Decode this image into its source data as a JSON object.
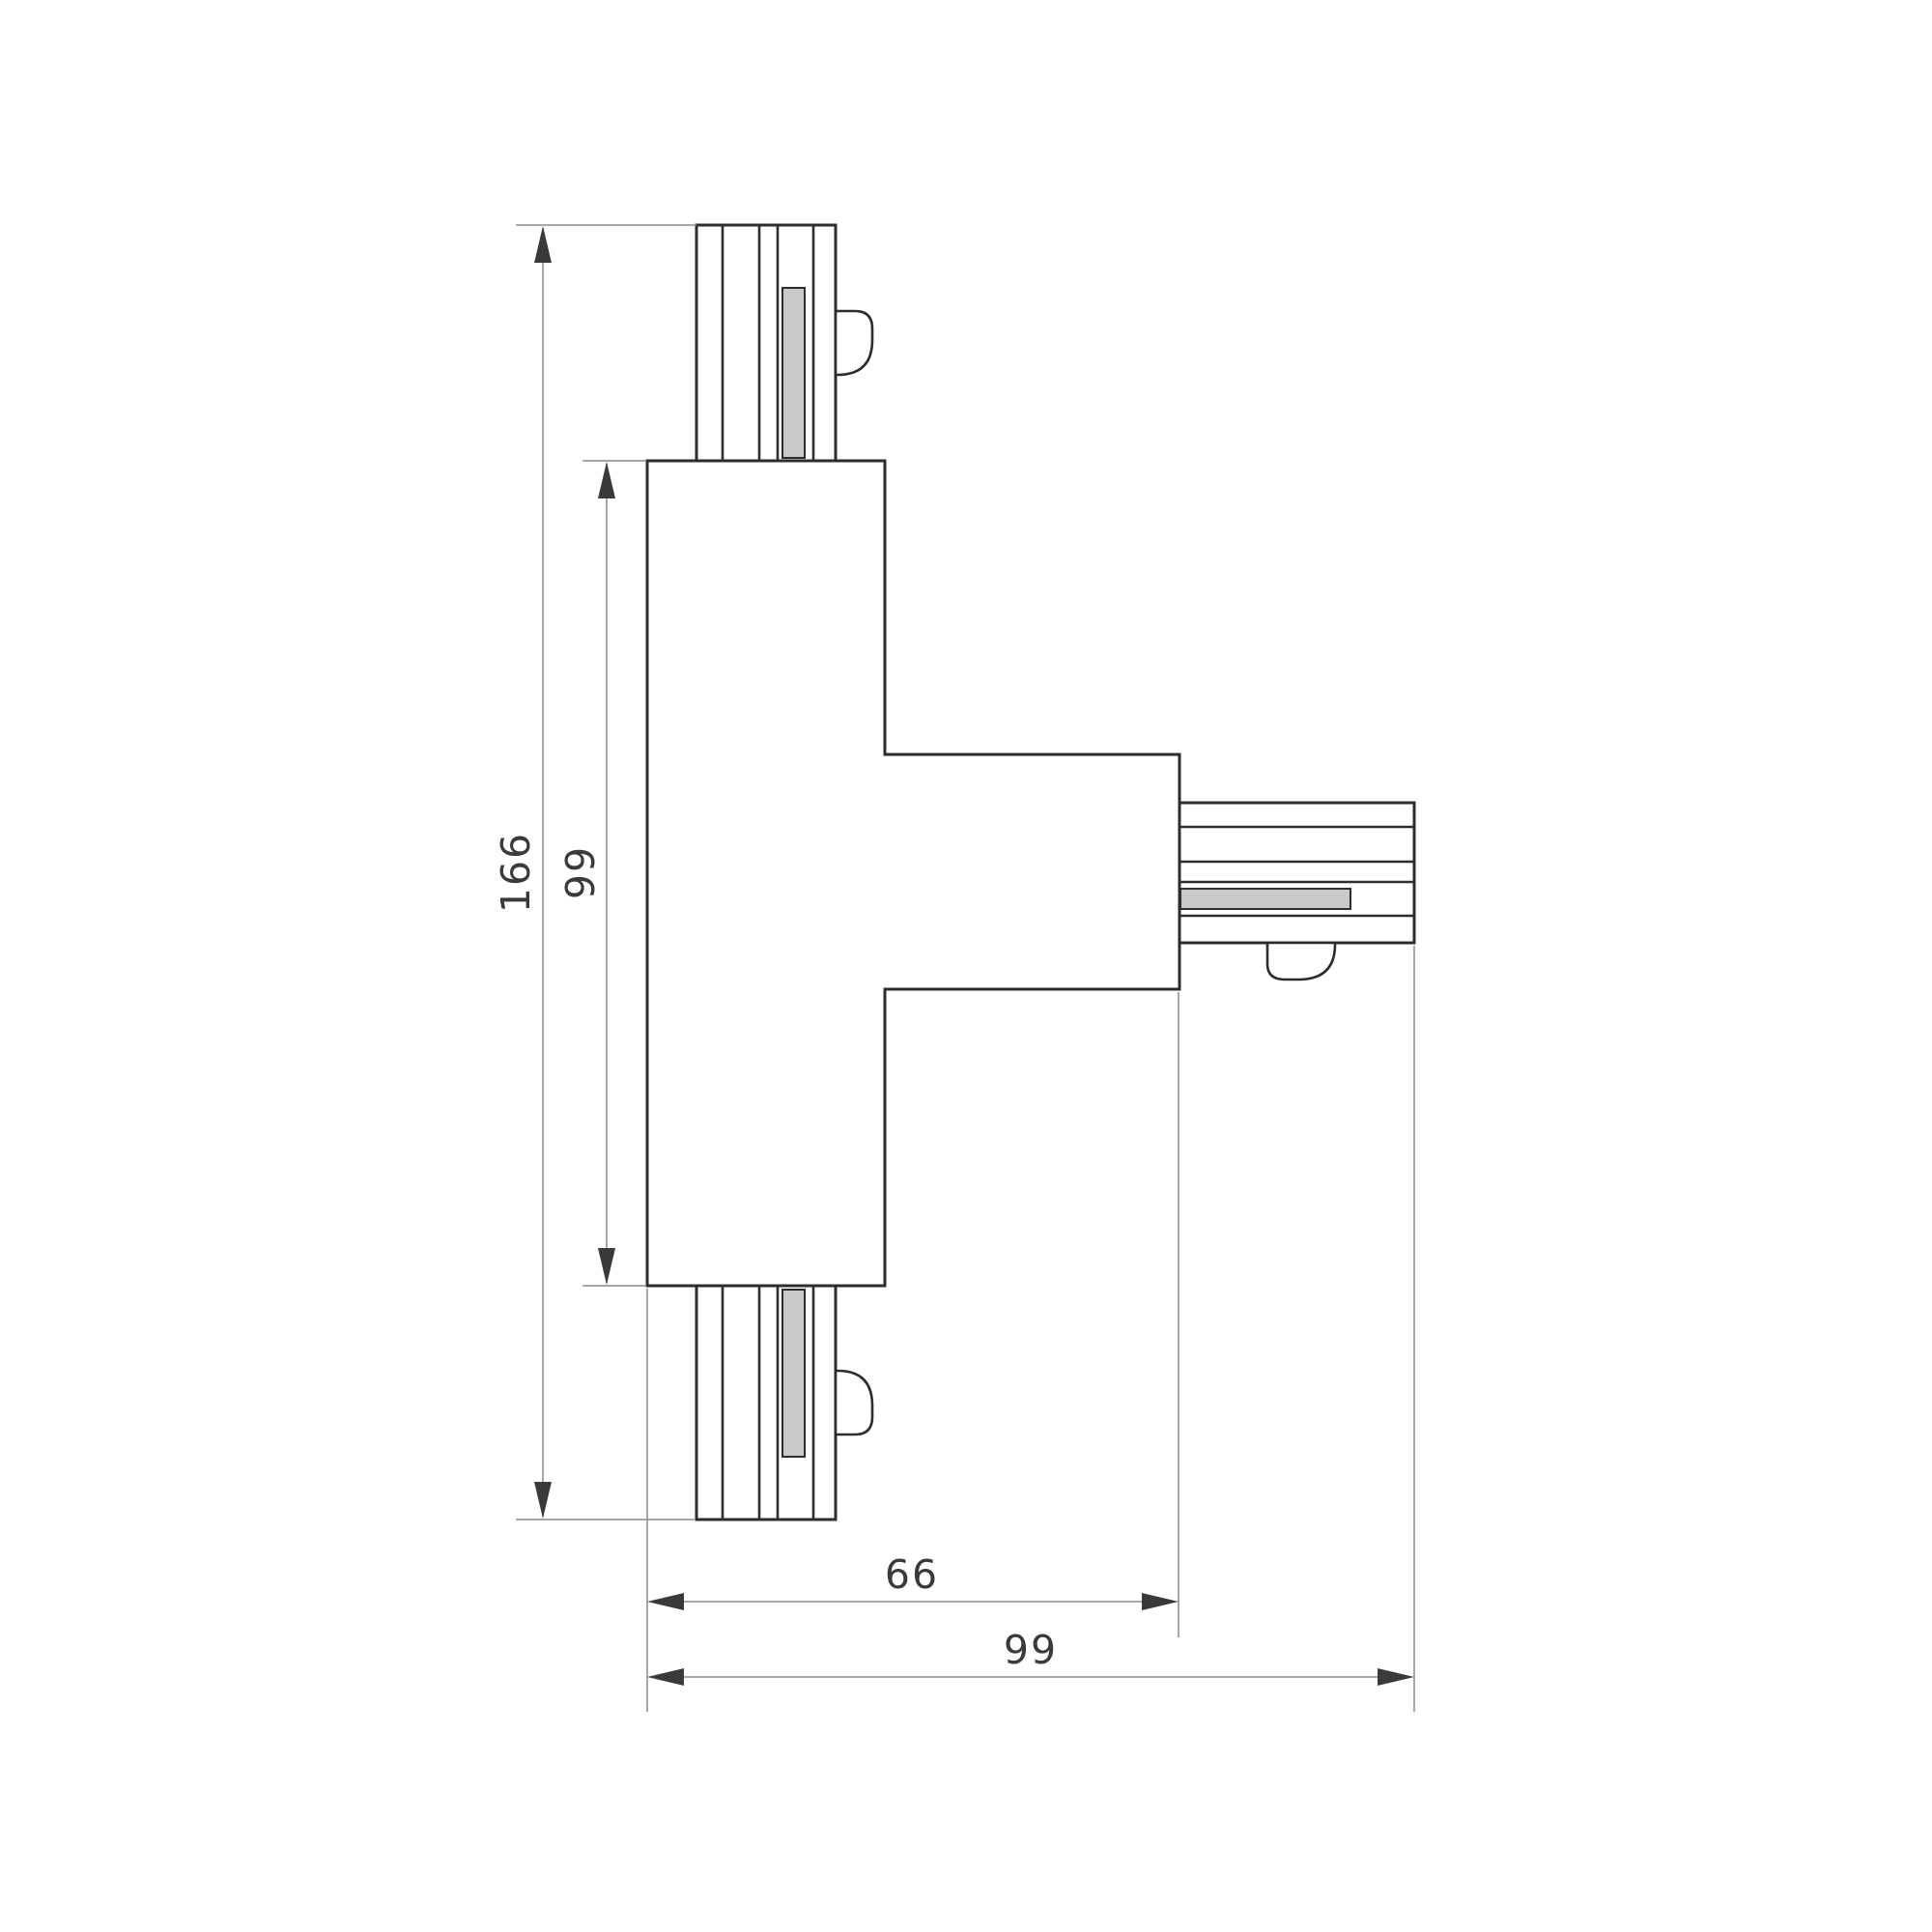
{
  "dimensions": {
    "overall_height": "166",
    "stem_height": "99",
    "stem_to_arm": "66",
    "overall_width": "99"
  },
  "colors": {
    "background": "#ffffff",
    "outline": "#2d2d2d",
    "dimension_lines": "#8a8a8a",
    "arrows_and_text": "#3a3a3a",
    "insert_fill": "#c9c9c9"
  }
}
